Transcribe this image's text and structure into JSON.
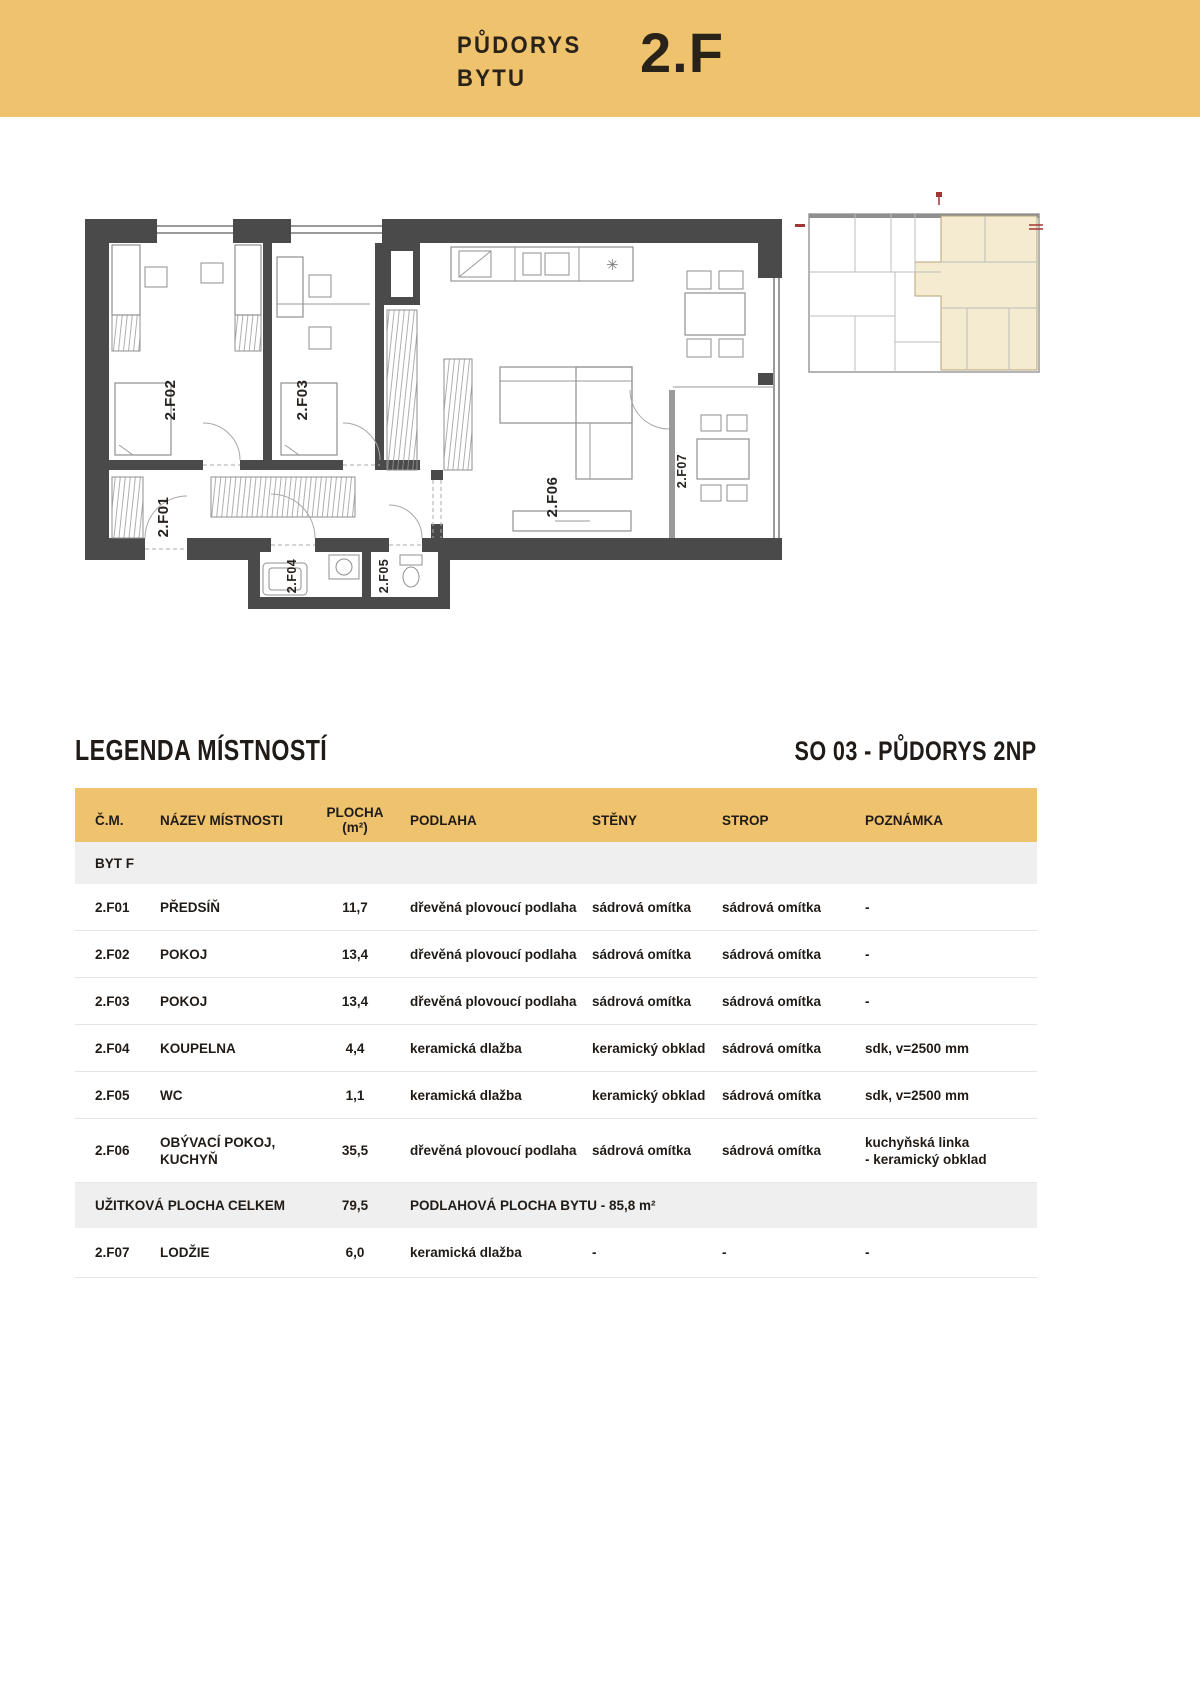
{
  "colors": {
    "gold": "#efc26e",
    "wall": "#4a4a4a",
    "plan_line": "#8f8f8f",
    "beige": "#f5ebd1",
    "beige_border": "#b7a377",
    "row_gray": "#efefef",
    "separator": "#e4e4e4",
    "text": "#201b17",
    "red": "#a03636"
  },
  "banner": {
    "line1": "PŮDORYS",
    "line2": "BYTU",
    "unit": "2.F"
  },
  "floorplan": {
    "labels": {
      "f01": "2.F01",
      "f02": "2.F02",
      "f03": "2.F03",
      "f04": "2.F04",
      "f05": "2.F05",
      "f06": "2.F06",
      "f07": "2.F07"
    },
    "kitchen_symbol": "✳"
  },
  "legend_header": {
    "title": "LEGENDA MÍSTNOSTÍ",
    "subtitle": "SO 03 - PŮDORYS 2NP"
  },
  "table": {
    "columns": {
      "cm": "Č.M.",
      "name": "NÁZEV MÍSTNOSTI",
      "area_l1": "PLOCHA",
      "area_l2": "(m²)",
      "floor": "PODLAHA",
      "walls": "STĚNY",
      "ceiling": "STROP",
      "note": "POZNÁMKA"
    },
    "group": "BYT F",
    "rows": [
      {
        "id": "2.F01",
        "name": "PŘEDSÍŇ",
        "area": "11,7",
        "floor": "dřevěná plovoucí podlaha",
        "walls": "sádrová omítka",
        "ceiling": "sádrová omítka",
        "note": "-"
      },
      {
        "id": "2.F02",
        "name": "POKOJ",
        "area": "13,4",
        "floor": "dřevěná plovoucí podlaha",
        "walls": "sádrová omítka",
        "ceiling": "sádrová omítka",
        "note": "-"
      },
      {
        "id": "2.F03",
        "name": "POKOJ",
        "area": "13,4",
        "floor": "dřevěná plovoucí podlaha",
        "walls": "sádrová omítka",
        "ceiling": "sádrová omítka",
        "note": "-"
      },
      {
        "id": "2.F04",
        "name": "KOUPELNA",
        "area": "4,4",
        "floor": "keramická dlažba",
        "walls": "keramický obklad",
        "ceiling": "sádrová omítka",
        "note": "sdk, v=2500 mm"
      },
      {
        "id": "2.F05",
        "name": "WC",
        "area": "1,1",
        "floor": "keramická dlažba",
        "walls": "keramický obklad",
        "ceiling": "sádrová omítka",
        "note": "sdk, v=2500 mm"
      },
      {
        "id": "2.F06",
        "name": "OBÝVACÍ POKOJ,\nKUCHYŇ",
        "area": "35,5",
        "floor": "dřevěná plovoucí podlaha",
        "walls": "sádrová omítka",
        "ceiling": "sádrová omítka",
        "note": "kuchyňská linka\n- keramický obklad"
      }
    ],
    "total": {
      "label": "UŽITKOVÁ PLOCHA CELKEM",
      "area": "79,5",
      "note": "PODLAHOVÁ PLOCHA BYTU - 85,8 m²"
    },
    "balcony_row": {
      "id": "2.F07",
      "name": "LODŽIE",
      "area": "6,0",
      "floor": "keramická dlažba",
      "walls": "-",
      "ceiling": "-",
      "note": "-"
    }
  }
}
